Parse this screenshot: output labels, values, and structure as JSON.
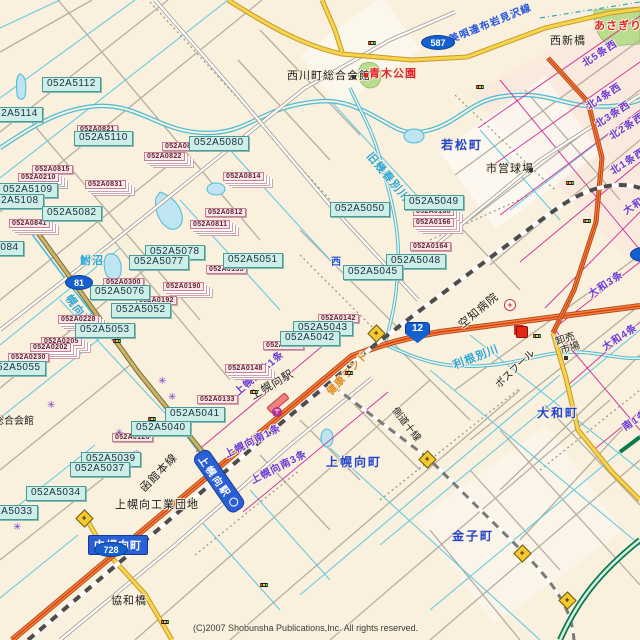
{
  "map": {
    "copyright": "(C)2007 Shobunsha Publications,Inc. All rights reserved.",
    "colors": {
      "land": "#faf0de",
      "water": "#49bcd8",
      "pond_fill": "#bfe4f2",
      "road_yellow": "#f6d44e",
      "road_orange": "#f08c3c",
      "road_red_line": "#e03818",
      "road_olive": "#c9b469",
      "expressway_green": "#0b7a4e",
      "railway": "#4c4c4c",
      "boundary_magenta": "#cf3b9a",
      "park_green": "#b9dc8e",
      "mesh_label_cyan_bg": "#cdefe8",
      "mesh_label_pink_bg": "#fbe6ea",
      "shield_blue": "#1560d0",
      "badge_blue": "#2a5fd6",
      "town_text": "#2244cc",
      "block_text": "#6a3ad6",
      "water_text": "#2fa8d8",
      "park_text": "#e02828",
      "orange_text": "#e08a20"
    },
    "labels": [
      {
        "text": "052A5112",
        "x": 42,
        "y": 77,
        "type": "mesh-cyan"
      },
      {
        "text": "052A5114",
        "x": -16,
        "y": 107,
        "type": "mesh-cyan"
      },
      {
        "text": "052A5110",
        "x": 74,
        "y": 131,
        "type": "mesh-cyan"
      },
      {
        "text": "052A5080",
        "x": 189,
        "y": 136,
        "type": "mesh-cyan"
      },
      {
        "text": "052A5109",
        "x": -2,
        "y": 183,
        "type": "mesh-cyan"
      },
      {
        "text": "052A5108",
        "x": -16,
        "y": 194,
        "type": "mesh-cyan"
      },
      {
        "text": "052A5082",
        "x": 42,
        "y": 206,
        "type": "mesh-cyan"
      },
      {
        "text": "052A5084",
        "x": -36,
        "y": 241,
        "type": "mesh-cyan"
      },
      {
        "text": "052A5078",
        "x": 145,
        "y": 245,
        "type": "mesh-cyan"
      },
      {
        "text": "052A5077",
        "x": 129,
        "y": 255,
        "type": "mesh-cyan"
      },
      {
        "text": "052A5051",
        "x": 223,
        "y": 253,
        "type": "mesh-cyan"
      },
      {
        "text": "052A5050",
        "x": 330,
        "y": 202,
        "type": "mesh-cyan"
      },
      {
        "text": "052A5049",
        "x": 404,
        "y": 195,
        "type": "mesh-cyan"
      },
      {
        "text": "052A5048",
        "x": 386,
        "y": 254,
        "type": "mesh-cyan"
      },
      {
        "text": "052A5045",
        "x": 343,
        "y": 265,
        "type": "mesh-cyan"
      },
      {
        "text": "052A5076",
        "x": 90,
        "y": 285,
        "type": "mesh-cyan"
      },
      {
        "text": "052A5052",
        "x": 111,
        "y": 303,
        "type": "mesh-cyan"
      },
      {
        "text": "052A5053",
        "x": 75,
        "y": 323,
        "type": "mesh-cyan"
      },
      {
        "text": "052A5055",
        "x": -14,
        "y": 361,
        "type": "mesh-cyan"
      },
      {
        "text": "052A5043",
        "x": 293,
        "y": 321,
        "type": "mesh-cyan"
      },
      {
        "text": "052A5042",
        "x": 280,
        "y": 331,
        "type": "mesh-cyan"
      },
      {
        "text": "052A5041",
        "x": 165,
        "y": 407,
        "type": "mesh-cyan"
      },
      {
        "text": "052A5040",
        "x": 131,
        "y": 421,
        "type": "mesh-cyan"
      },
      {
        "text": "052A5039",
        "x": 81,
        "y": 452,
        "type": "mesh-cyan"
      },
      {
        "text": "052A5037",
        "x": 70,
        "y": 462,
        "type": "mesh-cyan"
      },
      {
        "text": "052A5034",
        "x": 26,
        "y": 486,
        "type": "mesh-cyan"
      },
      {
        "text": "052A5033",
        "x": -22,
        "y": 505,
        "type": "mesh-cyan"
      },
      {
        "text": "052A0821",
        "x": 77,
        "y": 125,
        "type": "mesh-pink"
      },
      {
        "text": "052A0817",
        "x": 162,
        "y": 142,
        "type": "mesh-pink"
      },
      {
        "text": "052A0822",
        "x": 144,
        "y": 152,
        "type": "mesh-pink",
        "stack": true
      },
      {
        "text": "052A0814",
        "x": 223,
        "y": 172,
        "type": "mesh-pink",
        "stack": true
      },
      {
        "text": "052A0812",
        "x": 205,
        "y": 208,
        "type": "mesh-pink"
      },
      {
        "text": "052A0811",
        "x": 190,
        "y": 220,
        "type": "mesh-pink",
        "stack": true
      },
      {
        "text": "052A0815",
        "x": 32,
        "y": 165,
        "type": "mesh-pink"
      },
      {
        "text": "052A0210",
        "x": 18,
        "y": 173,
        "type": "mesh-pink",
        "stack": true
      },
      {
        "text": "052A0831",
        "x": 85,
        "y": 180,
        "type": "mesh-pink",
        "stack": true
      },
      {
        "text": "052A0841",
        "x": 9,
        "y": 219,
        "type": "mesh-pink",
        "stack": true
      },
      {
        "text": "052A0300",
        "x": 103,
        "y": 278,
        "type": "mesh-pink"
      },
      {
        "text": "052A0190",
        "x": 163,
        "y": 282,
        "type": "mesh-pink",
        "stack": true
      },
      {
        "text": "052A0192",
        "x": 136,
        "y": 296,
        "type": "mesh-pink"
      },
      {
        "text": "052A0228",
        "x": 58,
        "y": 315,
        "type": "mesh-pink",
        "stack": true
      },
      {
        "text": "052A0205",
        "x": 41,
        "y": 337,
        "type": "mesh-pink",
        "stack": true
      },
      {
        "text": "052A0202",
        "x": 30,
        "y": 343,
        "type": "mesh-pink",
        "stack": true
      },
      {
        "text": "052A0230",
        "x": 8,
        "y": 353,
        "type": "mesh-pink"
      },
      {
        "text": "052A0135",
        "x": 206,
        "y": 265,
        "type": "mesh-pink"
      },
      {
        "text": "052A0142",
        "x": 318,
        "y": 314,
        "type": "mesh-pink"
      },
      {
        "text": "052A0147",
        "x": 263,
        "y": 341,
        "type": "mesh-pink"
      },
      {
        "text": "052A0148",
        "x": 225,
        "y": 364,
        "type": "mesh-pink",
        "stack": true
      },
      {
        "text": "052A0133",
        "x": 197,
        "y": 395,
        "type": "mesh-pink"
      },
      {
        "text": "052A0126",
        "x": 112,
        "y": 433,
        "type": "mesh-pink"
      },
      {
        "text": "052A0168",
        "x": 413,
        "y": 207,
        "type": "mesh-pink",
        "stack": true
      },
      {
        "text": "052A0166",
        "x": 413,
        "y": 218,
        "type": "mesh-pink",
        "stack": true
      },
      {
        "text": "052A0164",
        "x": 410,
        "y": 242,
        "type": "mesh-pink"
      },
      {
        "text": "若松町",
        "x": 441,
        "y": 139,
        "type": "town"
      },
      {
        "text": "上幌向町",
        "x": 326,
        "y": 456,
        "type": "town"
      },
      {
        "text": "大和町",
        "x": 537,
        "y": 407,
        "type": "town"
      },
      {
        "text": "金子町",
        "x": 452,
        "y": 530,
        "type": "town"
      },
      {
        "text": "西川町総合会館",
        "x": 287,
        "y": 71,
        "type": "poi"
      },
      {
        "text": "西新橋",
        "x": 550,
        "y": 36,
        "type": "poi"
      },
      {
        "text": "市営球場",
        "x": 486,
        "y": 164,
        "type": "poi"
      },
      {
        "text": "協和橋",
        "x": 111,
        "y": 596,
        "type": "poi"
      },
      {
        "text": "上幌向工業団地",
        "x": 115,
        "y": 500,
        "type": "poi"
      },
      {
        "text": "総合会館",
        "x": -6,
        "y": 417,
        "type": "poi-sm"
      },
      {
        "text": "卸売",
        "x": 556,
        "y": 338,
        "type": "poi-sm",
        "rot": -18
      },
      {
        "text": "市場",
        "x": 561,
        "y": 347,
        "type": "poi-sm",
        "rot": -18
      },
      {
        "text": "西",
        "x": 331,
        "y": 258,
        "type": "roadname"
      },
      {
        "text": "上幌向駅",
        "x": 252,
        "y": 392,
        "type": "poi",
        "rot": -30
      },
      {
        "text": "函館本線",
        "x": 143,
        "y": 485,
        "type": "poi",
        "rot": -46
      },
      {
        "text": "空知病院",
        "x": 461,
        "y": 321,
        "type": "poi",
        "rot": -40
      },
      {
        "text": "ポスフール",
        "x": 498,
        "y": 382,
        "type": "poi-sm",
        "rot": -44
      },
      {
        "text": "側道十線",
        "x": 393,
        "y": 404,
        "type": "poi-sm",
        "rot": 52
      },
      {
        "text": "健康ランド",
        "x": 330,
        "y": 389,
        "type": "orange-poi",
        "rot": -47
      },
      {
        "text": "鮒沼",
        "x": 80,
        "y": 256,
        "type": "water"
      },
      {
        "text": "旧幾春別川",
        "x": 368,
        "y": 149,
        "type": "water",
        "rot": 50
      },
      {
        "text": "利根別川",
        "x": 454,
        "y": 361,
        "type": "water",
        "rot": -21
      },
      {
        "text": "幌向運河",
        "x": 67,
        "y": 291,
        "type": "water",
        "rot": 55
      },
      {
        "text": "美唄達布岩見沢線",
        "x": 450,
        "y": 36,
        "type": "roadname",
        "rot": -22
      },
      {
        "text": "あさぎり公園",
        "x": 594,
        "y": 21,
        "type": "park"
      },
      {
        "text": "青木公園",
        "x": 369,
        "y": 69,
        "type": "park"
      },
      {
        "text": "北5条西",
        "x": 584,
        "y": 60,
        "type": "block",
        "rot": -33
      },
      {
        "text": "北4条西",
        "x": 588,
        "y": 103,
        "type": "block",
        "rot": -33
      },
      {
        "text": "北3条西",
        "x": 597,
        "y": 121,
        "type": "block",
        "rot": -33
      },
      {
        "text": "北2条西",
        "x": 611,
        "y": 133,
        "type": "block",
        "rot": -33
      },
      {
        "text": "北1条西",
        "x": 612,
        "y": 168,
        "type": "block",
        "rot": -33
      },
      {
        "text": "大和1条",
        "x": 625,
        "y": 208,
        "type": "block",
        "rot": -33
      },
      {
        "text": "大和3条",
        "x": 590,
        "y": 291,
        "type": "block",
        "rot": -33
      },
      {
        "text": "大和4条",
        "x": 604,
        "y": 344,
        "type": "block",
        "rot": -33
      },
      {
        "text": "南1条",
        "x": 624,
        "y": 424,
        "type": "block",
        "rot": -33
      },
      {
        "text": "上幌向北1条",
        "x": 237,
        "y": 389,
        "type": "block",
        "rot": -41
      },
      {
        "text": "上幌向南1条",
        "x": 226,
        "y": 451,
        "type": "block",
        "rot": -27
      },
      {
        "text": "上幌向南3条",
        "x": 252,
        "y": 477,
        "type": "block",
        "rot": -27
      }
    ],
    "shields": [
      {
        "num": "81",
        "x": 65,
        "y": 275,
        "w": 26,
        "h": 13,
        "shape": "oval"
      },
      {
        "num": "587",
        "x": 421,
        "y": 35,
        "w": 32,
        "h": 13,
        "shape": "oval"
      },
      {
        "num": "728",
        "x": 94,
        "y": 542,
        "w": 32,
        "h": 13,
        "shape": "oval"
      },
      {
        "num": "6",
        "x": 630,
        "y": 247,
        "w": 24,
        "h": 13,
        "shape": "oval"
      },
      {
        "num": "12",
        "x": 405,
        "y": 322,
        "w": 23,
        "h": 19,
        "shape": "tri"
      }
    ],
    "badge": {
      "text": "中幌向町",
      "x": 88,
      "y": 535
    },
    "station_banner": {
      "text": "上幌向駅",
      "x": 199,
      "y": 443,
      "rot": 55
    },
    "icons": {
      "signals": [
        [
          368,
          41
        ],
        [
          476,
          85
        ],
        [
          583,
          219
        ],
        [
          113,
          339
        ],
        [
          345,
          371
        ],
        [
          533,
          334
        ],
        [
          250,
          390
        ],
        [
          148,
          417
        ],
        [
          161,
          620
        ],
        [
          260,
          583
        ],
        [
          81,
          514
        ],
        [
          566,
          181
        ]
      ],
      "diamonds": [
        [
          376,
          333
        ],
        [
          84,
          518
        ],
        [
          427,
          459
        ],
        [
          522,
          553
        ],
        [
          567,
          600
        ]
      ],
      "asterisks": [
        [
          115,
          429
        ],
        [
          132,
          450
        ],
        [
          13,
          523
        ],
        [
          158,
          377
        ],
        [
          168,
          393
        ],
        [
          47,
          401
        ]
      ],
      "hospital": [
        504,
        299
      ],
      "post_office": [
        272,
        407
      ],
      "shopping": [
        516,
        326
      ],
      "buildings": [
        [
          352,
          75
        ],
        [
          529,
          168
        ],
        [
          564,
          356
        ]
      ],
      "red_dot": [
        364,
        73
      ]
    }
  }
}
